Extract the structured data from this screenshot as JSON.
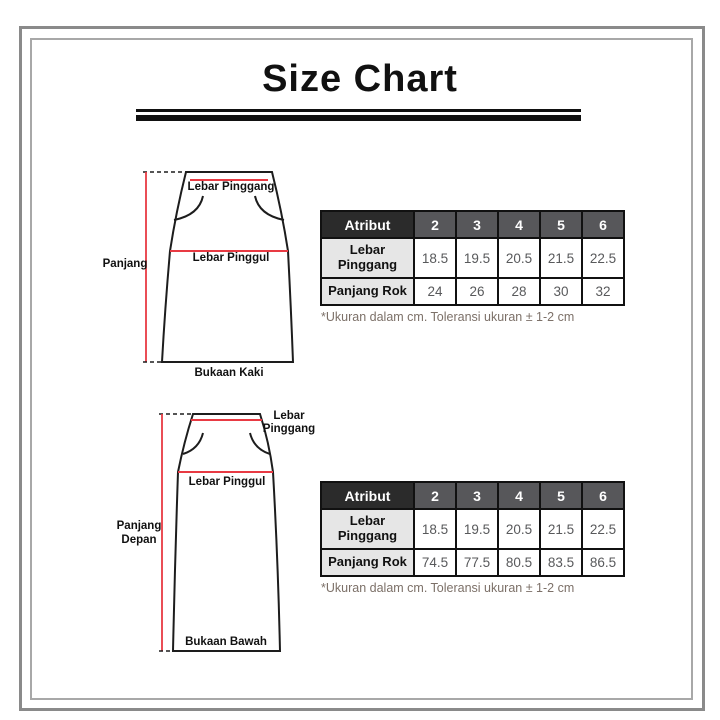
{
  "title": "Size Chart",
  "sections": [
    {
      "name": "short-skirt",
      "diagram": {
        "waist_label": "Lebar Pinggang",
        "hip_label": "Lebar Pinggul",
        "length_label": "Panjang",
        "hem_label": "Bukaan Kaki"
      },
      "table": {
        "header": [
          "Atribut",
          "2",
          "3",
          "4",
          "5",
          "6"
        ],
        "rows": [
          {
            "label": "Lebar Pinggang",
            "values": [
              "18.5",
              "19.5",
              "20.5",
              "21.5",
              "22.5"
            ]
          },
          {
            "label": "Panjang Rok",
            "values": [
              "24",
              "26",
              "28",
              "30",
              "32"
            ]
          }
        ]
      },
      "note": "*Ukuran dalam cm. Toleransi ukuran ± 1-2 cm"
    },
    {
      "name": "long-skirt",
      "diagram": {
        "waist_label_line1": "Lebar",
        "waist_label_line2": "Pinggang",
        "hip_label": "Lebar Pinggul",
        "length_label_line1": "Panjang",
        "length_label_line2": "Depan",
        "hem_label": "Bukaan Bawah"
      },
      "table": {
        "header": [
          "Atribut",
          "2",
          "3",
          "4",
          "5",
          "6"
        ],
        "rows": [
          {
            "label": "Lebar Pinggang",
            "values": [
              "18.5",
              "19.5",
              "20.5",
              "21.5",
              "22.5"
            ]
          },
          {
            "label": "Panjang Rok",
            "values": [
              "74.5",
              "77.5",
              "80.5",
              "83.5",
              "86.5"
            ]
          }
        ]
      },
      "note": "*Ukuran dalam cm. Toleransi ukuran ± 1-2 cm"
    }
  ],
  "colors": {
    "accent_red": "#e83a43",
    "outline_black": "#1d1d1d",
    "table_header_dark_bg": "#2b2b2b",
    "table_header_gray_bg": "#57575a",
    "table_label_bg": "#e6e6e6",
    "table_value_text": "#58595b",
    "note_text": "#7c7068",
    "frame_gray": "#8a8a8a"
  }
}
